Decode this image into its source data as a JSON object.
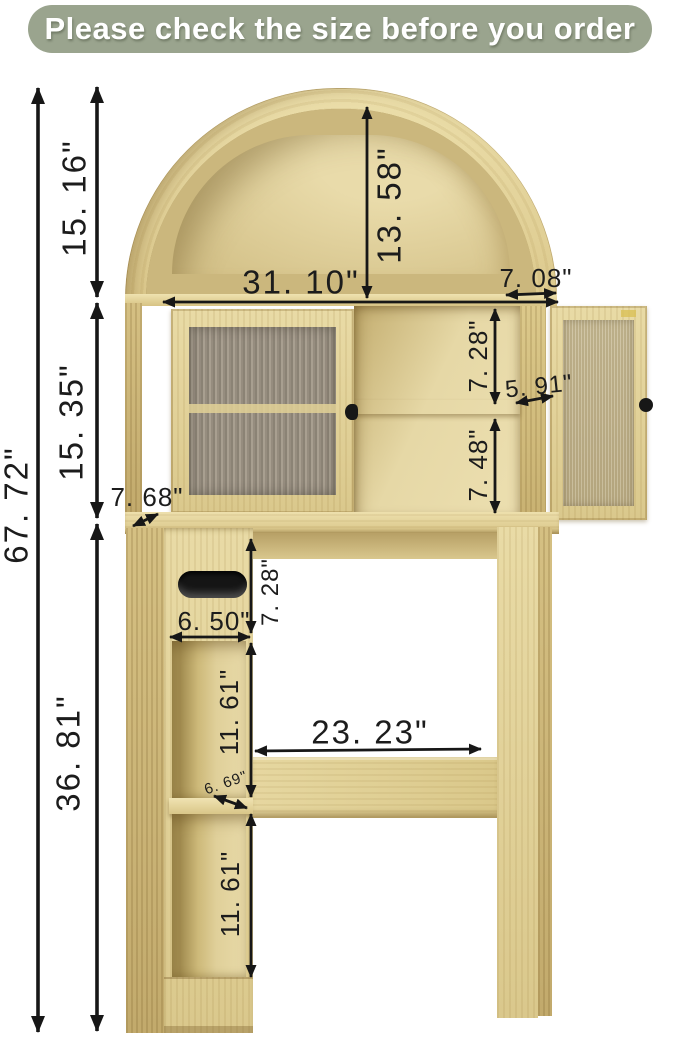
{
  "banner": {
    "text": "Please check the size before you order",
    "bg_color": "#9aa48e",
    "text_color": "#ffffff"
  },
  "style": {
    "wood_color": "#decb92",
    "glass_color": "#9a9183",
    "arrow_color": "#1a1a1a"
  },
  "dimensions": {
    "overall_height": "67. 72\"",
    "arch_section_height": "15. 16\"",
    "cabinet_section_height": "15. 35\"",
    "base_section_height": "36. 81\"",
    "arch_inner_height": "13. 58\"",
    "top_width": "31. 10\"",
    "top_depth": "7. 08\"",
    "upper_shelf_height": "7. 28\"",
    "shelf_depth": "5. 91\"",
    "lower_shelf_height": "7. 48\"",
    "side_depth": "7. 68\"",
    "tissue_compartment_height": "7. 28\"",
    "tissue_compartment_width": "6. 50\"",
    "cubby_top_height": "11. 61\"",
    "cubby_shelf_depth": "6. 69\"",
    "cubby_bottom_height": "11. 61\"",
    "clearance_width": "23. 23\""
  }
}
